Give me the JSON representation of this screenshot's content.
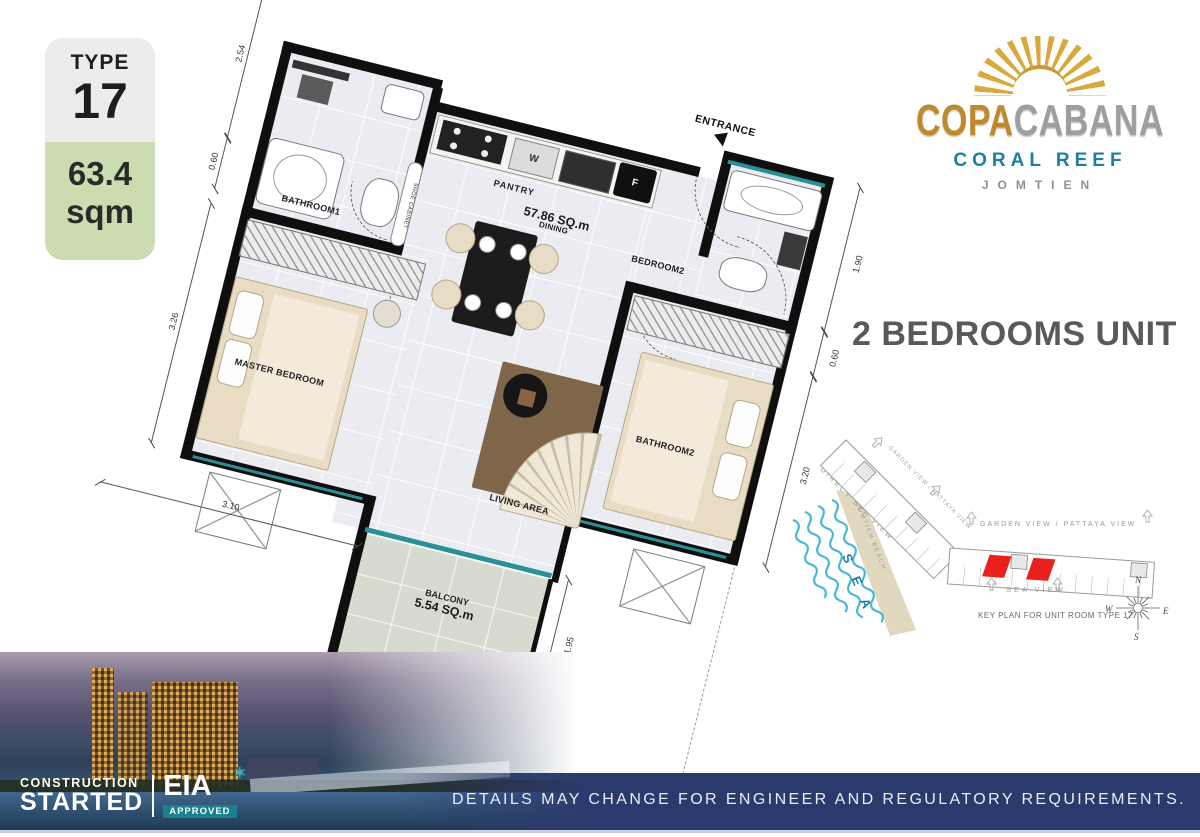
{
  "badge": {
    "type_label": "TYPE",
    "type_number": "17",
    "area_value": "63.4",
    "area_unit": "sqm"
  },
  "logo": {
    "name_gold": "COPA",
    "name_silver": "CABANA",
    "subtitle": "CORAL REEF",
    "location": "JOMTIEN"
  },
  "unit_title": "2 BEDROOMS UNIT",
  "floorplan": {
    "total_area": "57.86 SQ.m",
    "entrance_label": "ENTRANCE",
    "rooms": {
      "bathroom1": "BATHROOM1",
      "pantry": "PANTRY",
      "bedroom2": "BEDROOM2",
      "bathroom2": "BATHROOM2",
      "master_bedroom": "MASTER BEDROOM",
      "living": "LIVING AREA",
      "dining": "DINING",
      "balcony": "BALCONY",
      "balcony_area": "5.54 SQ.m",
      "shoe_cabinet": "SHOE CABINET"
    },
    "appliances": {
      "washer": "W",
      "fridge": "F"
    },
    "dimensions": {
      "left_upper": "2.54",
      "left_small": "0.60",
      "left_lower": "3.26",
      "under_master": "3.10",
      "balcony_width": "2.85",
      "bottom_long": "5.65",
      "bottom_right": "2.70",
      "balcony_depth": "1.95",
      "right_upper": "1.90",
      "right_small": "0.60",
      "right_lower": "3.20"
    }
  },
  "keyplan": {
    "garden_view_diagonal": "GARDEN VIEW / PATTAYA VIEW",
    "direct_sea_view": "DIRECT SEA VIEW",
    "jomtien_beach": "JOMTIEN BEACH",
    "sea": "S E A",
    "garden_view": "GARDEN VIEW / PATTAYA VIEW",
    "sea_view": "SEA VIEW",
    "caption": "KEY PLAN FOR UNIT ROOM TYPE 17",
    "compass": {
      "n": "N",
      "e": "E",
      "s": "S",
      "w": "W"
    }
  },
  "photo": {
    "line1": "CONSTRUCTION",
    "line2": "STARTED",
    "eia": "EIA",
    "star": "✶",
    "approved": "APPROVED"
  },
  "bottom_bar": {
    "disclaimer": "DETAILS MAY CHANGE FOR ENGINEER AND REGULATORY REQUIREMENTS."
  },
  "colors": {
    "navy": "#2b3a6d",
    "badge_green": "#cbdcb0",
    "gold": "#bd8b2e",
    "silver": "#9e9e9e",
    "coral_teal": "#1c7f9f",
    "keyplan_red": "#e8211d",
    "wave_blue": "#45b8d8"
  }
}
